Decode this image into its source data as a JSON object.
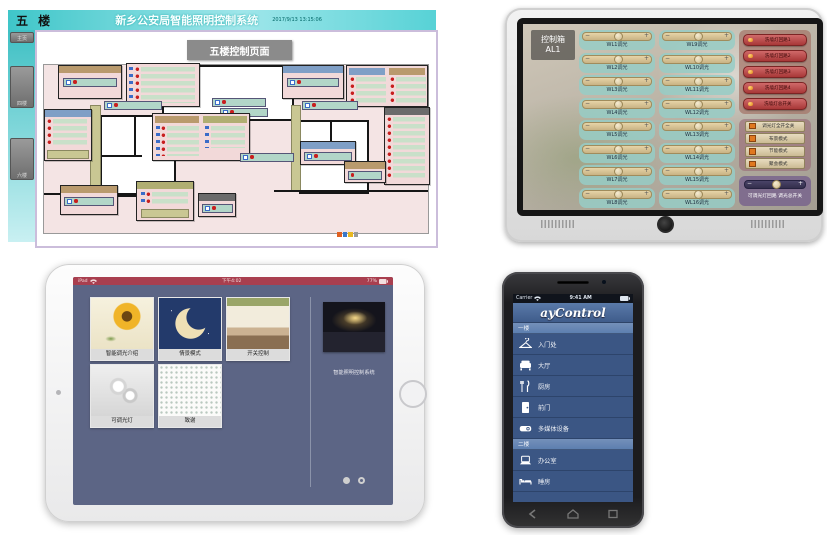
{
  "desktop": {
    "floor_label": "五 楼",
    "title": "新乡公安局智能照明控制系统",
    "timestamp": "2017/9/13 13:15:06",
    "page_header": "五楼控制页面",
    "sidebar": [
      "主页",
      "四楼",
      "六楼"
    ]
  },
  "tablet": {
    "box_label": "控制箱",
    "box_id": "AL1",
    "minus": "−",
    "plus": "+",
    "sliders_col1": [
      "WL1调光",
      "WL2调光",
      "WL3调光",
      "WL4调光",
      "WL5调光",
      "WL6调光",
      "WL7调光",
      "WL8调光"
    ],
    "sliders_col2": [
      "WL9调光",
      "WL10调光",
      "WL11调光",
      "WL12调光",
      "WL13调光",
      "WL14调光",
      "WL15调光",
      "WL16调光"
    ],
    "circuit_buttons": [
      "洗墙灯回路1",
      "洗墙灯回路2",
      "洗墙灯回路3",
      "洗墙灯回路4",
      "洗墙灯总开关"
    ],
    "mode_buttons": [
      "调光灯全开全关",
      "布景模式",
      "节能模式",
      "聚会模式"
    ],
    "master_label": "可调光灯回路 调光总开关"
  },
  "ipad": {
    "status_left": "iPad",
    "status_time": "下午4:02",
    "status_battery": "77%",
    "tiles": [
      {
        "label": "智能调光介绍"
      },
      {
        "label": "情景模式"
      },
      {
        "label": "开关控制"
      },
      {
        "label": "可调光灯"
      },
      {
        "label": "致谢"
      }
    ],
    "system_label": "智能照明控制系统"
  },
  "phone": {
    "carrier": "Carrier",
    "time": "9:41 AM",
    "app_title": "ayControl",
    "floors": [
      {
        "label": "一楼",
        "items": [
          {
            "label": "入门处"
          },
          {
            "label": "大厅"
          },
          {
            "label": "厨房"
          },
          {
            "label": "前门"
          },
          {
            "label": "多媒体设备"
          }
        ]
      },
      {
        "label": "二楼",
        "items": [
          {
            "label": "办公室"
          },
          {
            "label": "睡房"
          }
        ]
      }
    ]
  }
}
